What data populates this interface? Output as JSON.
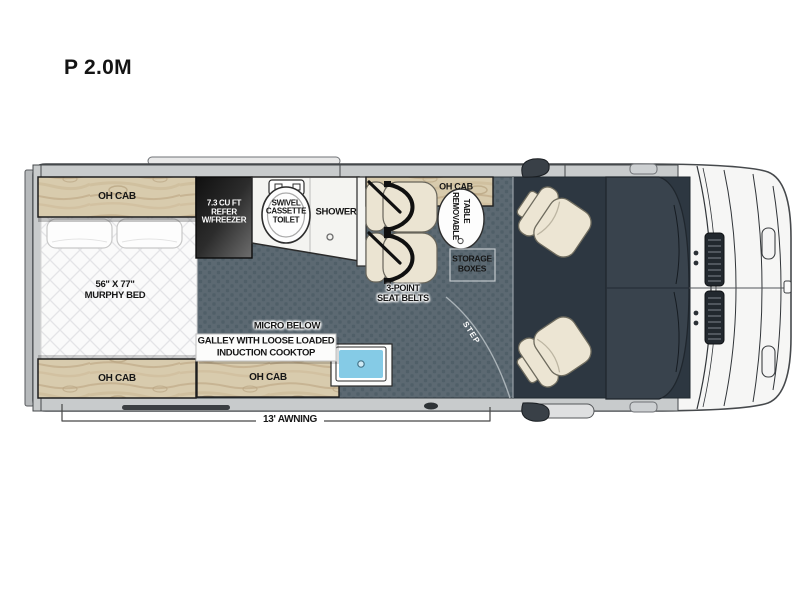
{
  "title": "P 2.0M",
  "floorplan": {
    "cabinets": {
      "top": "OH CAB",
      "bottom": "OH CAB",
      "galley": "OH CAB",
      "dinette": "OH CAB"
    },
    "murphy_bed": {
      "size": "56\" X 77\"",
      "name": "MURPHY BED"
    },
    "refrigerator": {
      "line1": "7.3 CU FT",
      "line2": "REFER",
      "line3": "W/FREEZER"
    },
    "toilet": {
      "line1": "SWIVEL",
      "line2": "CASSETTE",
      "line3": "TOILET"
    },
    "shower": "SHOWER",
    "seat_belts": {
      "line1": "3-POINT",
      "line2": "SEAT BELTS"
    },
    "table": {
      "line1": "REMOVABLE",
      "line2": "TABLE"
    },
    "storage": {
      "line1": "STORAGE",
      "line2": "BOXES"
    },
    "micro": "MICRO BELOW",
    "galley": {
      "line1": "GALLEY WITH LOOSE LOADED",
      "line2": "INDUCTION COOKTOP"
    },
    "step": "STEP",
    "awning": "13' AWNING"
  },
  "colors": {
    "floor": "#5c6972",
    "floor_dot": "#505f68",
    "cab_floor": "#2d3741",
    "dashboard": "#39434d",
    "wood": "#d8cbad",
    "bed": "#fafafa",
    "sink": "#85cbe6",
    "seat": "#ebe4d2",
    "wall_band": "#c8cbcc"
  }
}
